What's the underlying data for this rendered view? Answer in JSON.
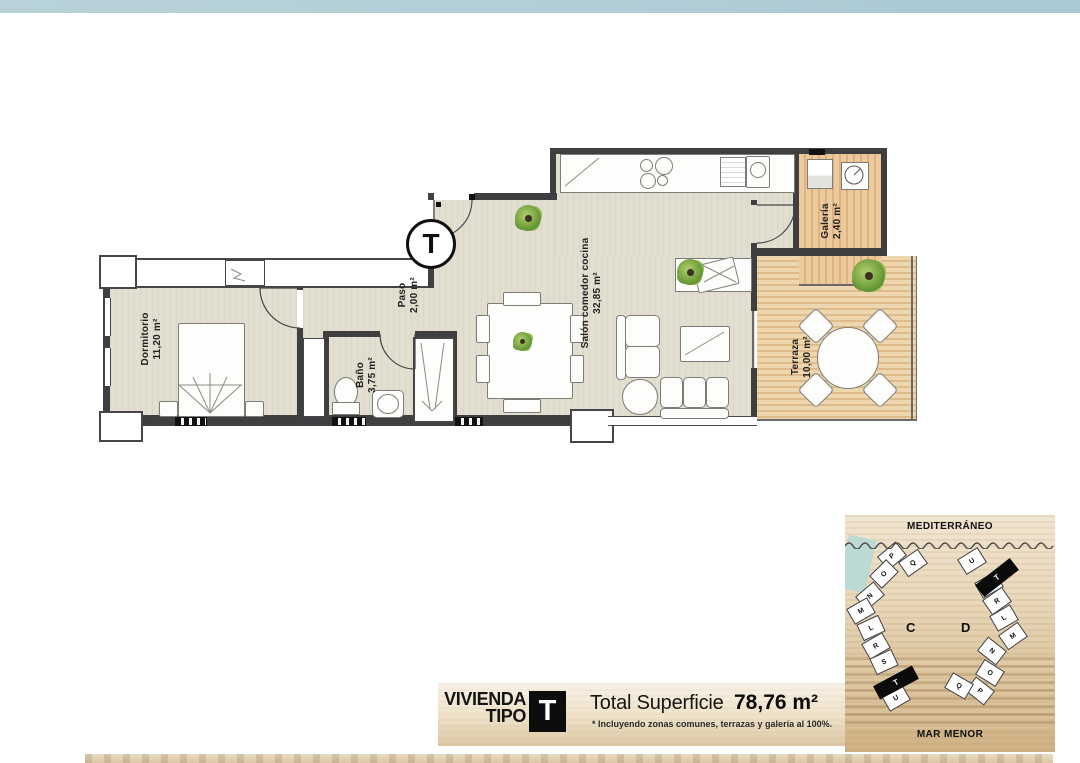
{
  "page": {
    "top_band_color": "#b2cdd6",
    "background": "#ffffff"
  },
  "floor_plan": {
    "entry_type_badge": "T",
    "rooms": [
      {
        "id": "dormitorio",
        "label": "Dormitorio",
        "area": "11,20 m²"
      },
      {
        "id": "bano",
        "label": "Baño",
        "area": "3,75 m²"
      },
      {
        "id": "paso",
        "label": "Paso",
        "area": "2,00 m²"
      },
      {
        "id": "salon",
        "label": "Salón comedor cocina",
        "area": "32,85 m²"
      },
      {
        "id": "galeria",
        "label": "Galería",
        "area": "2,40 m²"
      },
      {
        "id": "terraza",
        "label": "Terraza",
        "area": "10,00 m²"
      }
    ],
    "colors": {
      "interior_floor": "#e2dfd1",
      "wood_floor": "#e2bc86",
      "wall": "#3f3f42"
    }
  },
  "title_plate": {
    "line1": "VIVIENDA",
    "line2": "TIPO",
    "type_letter": "T",
    "total_label": "Total Superficie",
    "total_value": "78,76 m²",
    "footnote": "* Incluyendo zonas comunes, terrazas y galería al 100%."
  },
  "site_map": {
    "sea_top": "MEDITERRÁNEO",
    "sea_bottom": "MAR MENOR",
    "highlight_unit": "T",
    "blocks": [
      {
        "name": "C",
        "units": [
          "P",
          "Q",
          "O",
          "N",
          "M",
          "L",
          "R",
          "S",
          "T",
          "U"
        ]
      },
      {
        "name": "D",
        "units": [
          "U",
          "T",
          "S",
          "R",
          "L",
          "M",
          "N",
          "O",
          "P",
          "Q"
        ]
      }
    ]
  }
}
